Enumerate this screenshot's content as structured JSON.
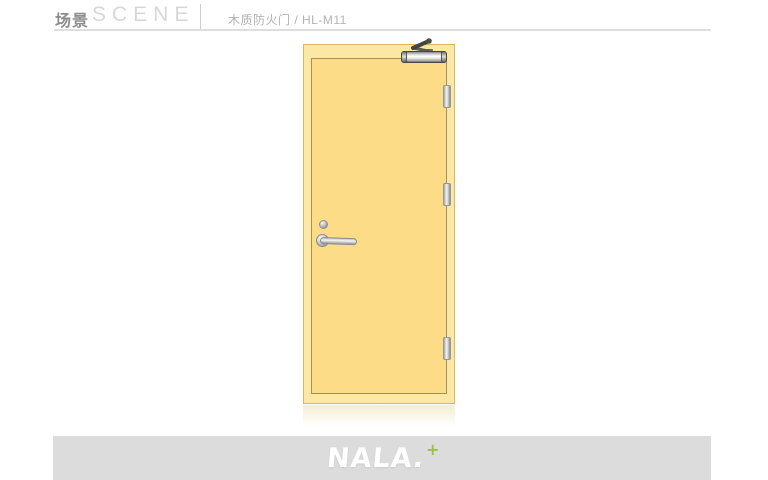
{
  "header": {
    "title_cn": "场景",
    "title_en": "SCENE",
    "product_label": "木质防火门 / HL-M11"
  },
  "scene": {
    "item": "wooden-fire-door",
    "door_color": "#fcdc86",
    "door_frame_color": "#fde7a4",
    "door_outline_color": "#9f9456",
    "hardware": [
      "door-closer",
      "hinge-top",
      "hinge-middle",
      "hinge-bottom",
      "lock-cylinder",
      "lever-handle"
    ]
  },
  "footer": {
    "brand": "NALA.",
    "brand_plus": "+",
    "accent_color": "#97c33c",
    "bar_color": "#dcdcdc"
  }
}
